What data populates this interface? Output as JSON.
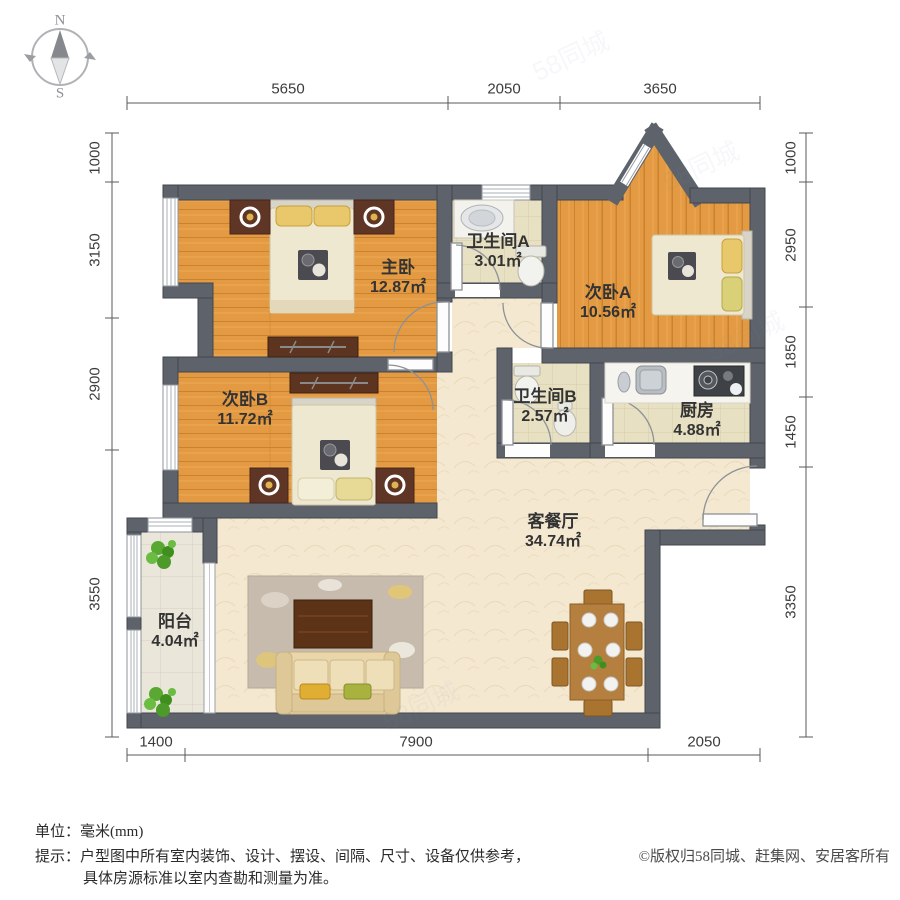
{
  "compass": {
    "north": "N",
    "south": "S"
  },
  "dimensions": {
    "top": [
      "5650",
      "2050",
      "3650"
    ],
    "bottom": [
      "1400",
      "7900",
      "2050"
    ],
    "left": [
      "1000",
      "3150",
      "2900",
      "3550"
    ],
    "right": [
      "1000",
      "2950",
      "1850",
      "1450",
      "3350"
    ]
  },
  "rooms": [
    {
      "id": "master-bedroom",
      "name": "主卧",
      "area": "12.87㎡"
    },
    {
      "id": "bathroom-a",
      "name": "卫生间A",
      "area": "3.01㎡"
    },
    {
      "id": "bedroom-a",
      "name": "次卧A",
      "area": "10.56㎡"
    },
    {
      "id": "bedroom-b",
      "name": "次卧B",
      "area": "11.72㎡"
    },
    {
      "id": "bathroom-b",
      "name": "卫生间B",
      "area": "2.57㎡"
    },
    {
      "id": "kitchen",
      "name": "厨房",
      "area": "4.88㎡"
    },
    {
      "id": "living-dining",
      "name": "客餐厅",
      "area": "34.74㎡"
    },
    {
      "id": "balcony",
      "name": "阳台",
      "area": "4.04㎡"
    }
  ],
  "footer": {
    "unit_note": "单位：毫米(mm)",
    "tip_line1": "提示：户型图中所有室内装饰、设计、摆设、间隔、尺寸、设备仅供参考，",
    "tip_line2": "具体房源标准以室内查勘和测量为准。",
    "copyright": "©版权归58同城、赶集网、安居客所有"
  },
  "watermark": "58同城",
  "colors": {
    "wall": "#5e636b",
    "wood_floor": "#e39a43",
    "tile_floor": "#e8e0c2",
    "living_floor": "#f4e8d0",
    "balcony_floor": "#ebe6da",
    "furniture_wood": "#5c3420",
    "bedding": "#efe8d0",
    "pillow_gold": "#e8c86a"
  }
}
